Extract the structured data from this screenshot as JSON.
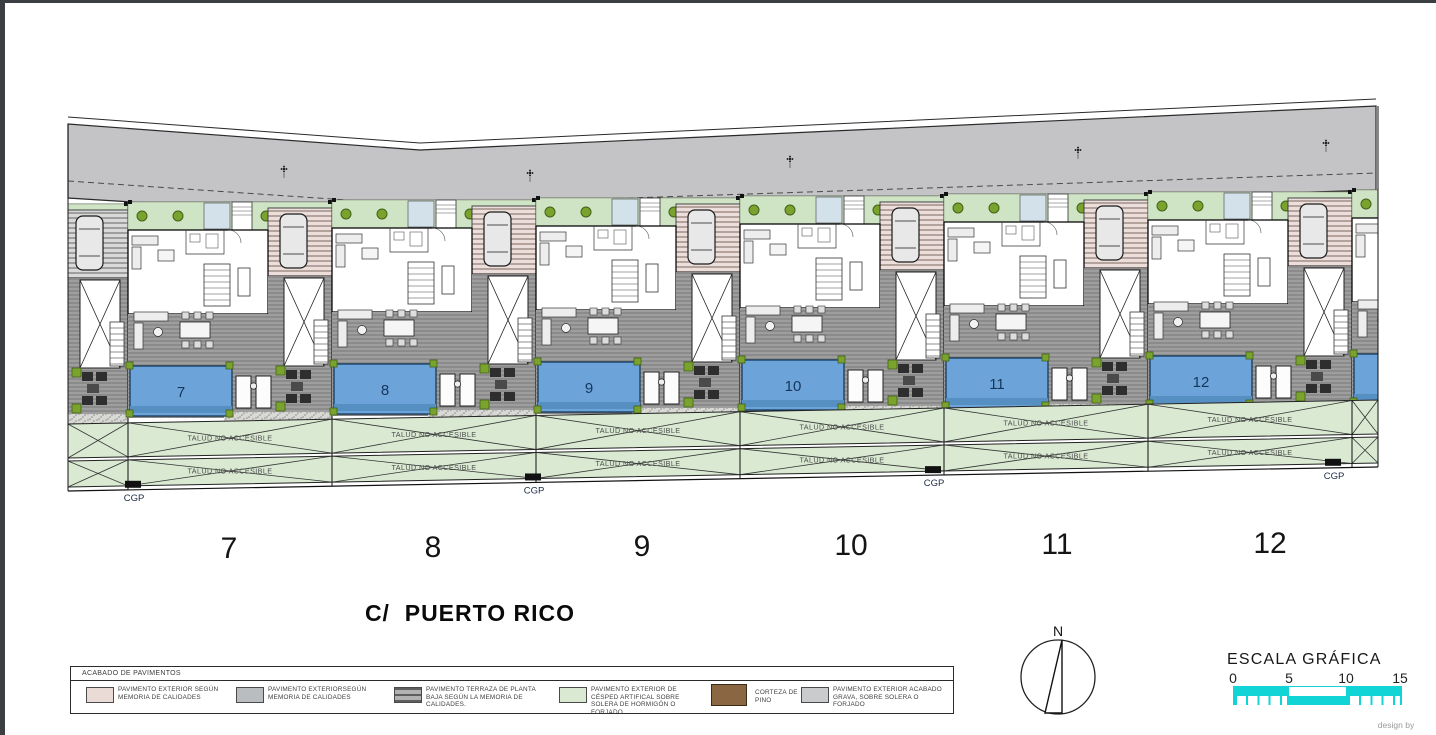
{
  "page": {
    "credit": "design by"
  },
  "site_plan": {
    "street_label": "C/  PUERTO RICO",
    "talud_label": "TALUD NO ACCESIBLE",
    "cgp_label": "CGP",
    "plots": [
      {
        "id": "7"
      },
      {
        "id": "8"
      },
      {
        "id": "9"
      },
      {
        "id": "10"
      },
      {
        "id": "11"
      },
      {
        "id": "12"
      }
    ],
    "colors": {
      "road": "#c4c4c7",
      "garden": "#cfe3c5",
      "talud": "#d9e9d2",
      "pool": "#6ca4da",
      "pool_dark": "#568fc2",
      "pool_number": "#16365c",
      "deck": "#9e9e9e",
      "deck_line": "#787878",
      "parking_bg": "#ecdfdb",
      "parking_line": "#a18e88",
      "parking_gray_bg": "#d9d9d9",
      "parking_gray_line": "#8a8a8a",
      "gravel": "#d8d8d4",
      "bush": "#7aa32e",
      "bush_edge": "#44611a",
      "porch": "#d3e2ea"
    }
  },
  "compass": {
    "north_label": "N"
  },
  "scale_bar": {
    "title": "ESCALA GRÁFICA",
    "ticks": [
      "0",
      "5",
      "10",
      "15"
    ],
    "color": "#10d4d6"
  },
  "legend": {
    "title": "ACABADO DE PAVIMENTOS",
    "items": [
      {
        "type": "plain",
        "color": "#eadbd7",
        "label": "PAVIMENTO EXTERIOR SEGÚN MEMORIA DE CALIDADES"
      },
      {
        "type": "plain",
        "color": "#b9bdc0",
        "label": "PAVIMENTO EXTERIORSEGÚN MEMORIA DE CALIDADES"
      },
      {
        "type": "striped",
        "color": "#9a9a9a",
        "label": "PAVIMENTO TERRAZA DE PLANTA BAJA SEGÚN LA MEMORIA DE CALIDADES."
      },
      {
        "type": "plain",
        "color": "#d9e9d2",
        "label": "PAVIMENTO EXTERIOR DE CÉSPED ARTIFICAL SOBRE SOLERA DE HORMIGÓN O FORJADO"
      },
      {
        "type": "brown",
        "color": "#8a6742",
        "label": "CORTEZA DE PINO"
      },
      {
        "type": "plain",
        "color": "#c9cbcd",
        "label": "PAVIMENTO EXTERIOR ACABADO GRAVA, SOBRE SOLERA O FORJADO"
      }
    ]
  }
}
